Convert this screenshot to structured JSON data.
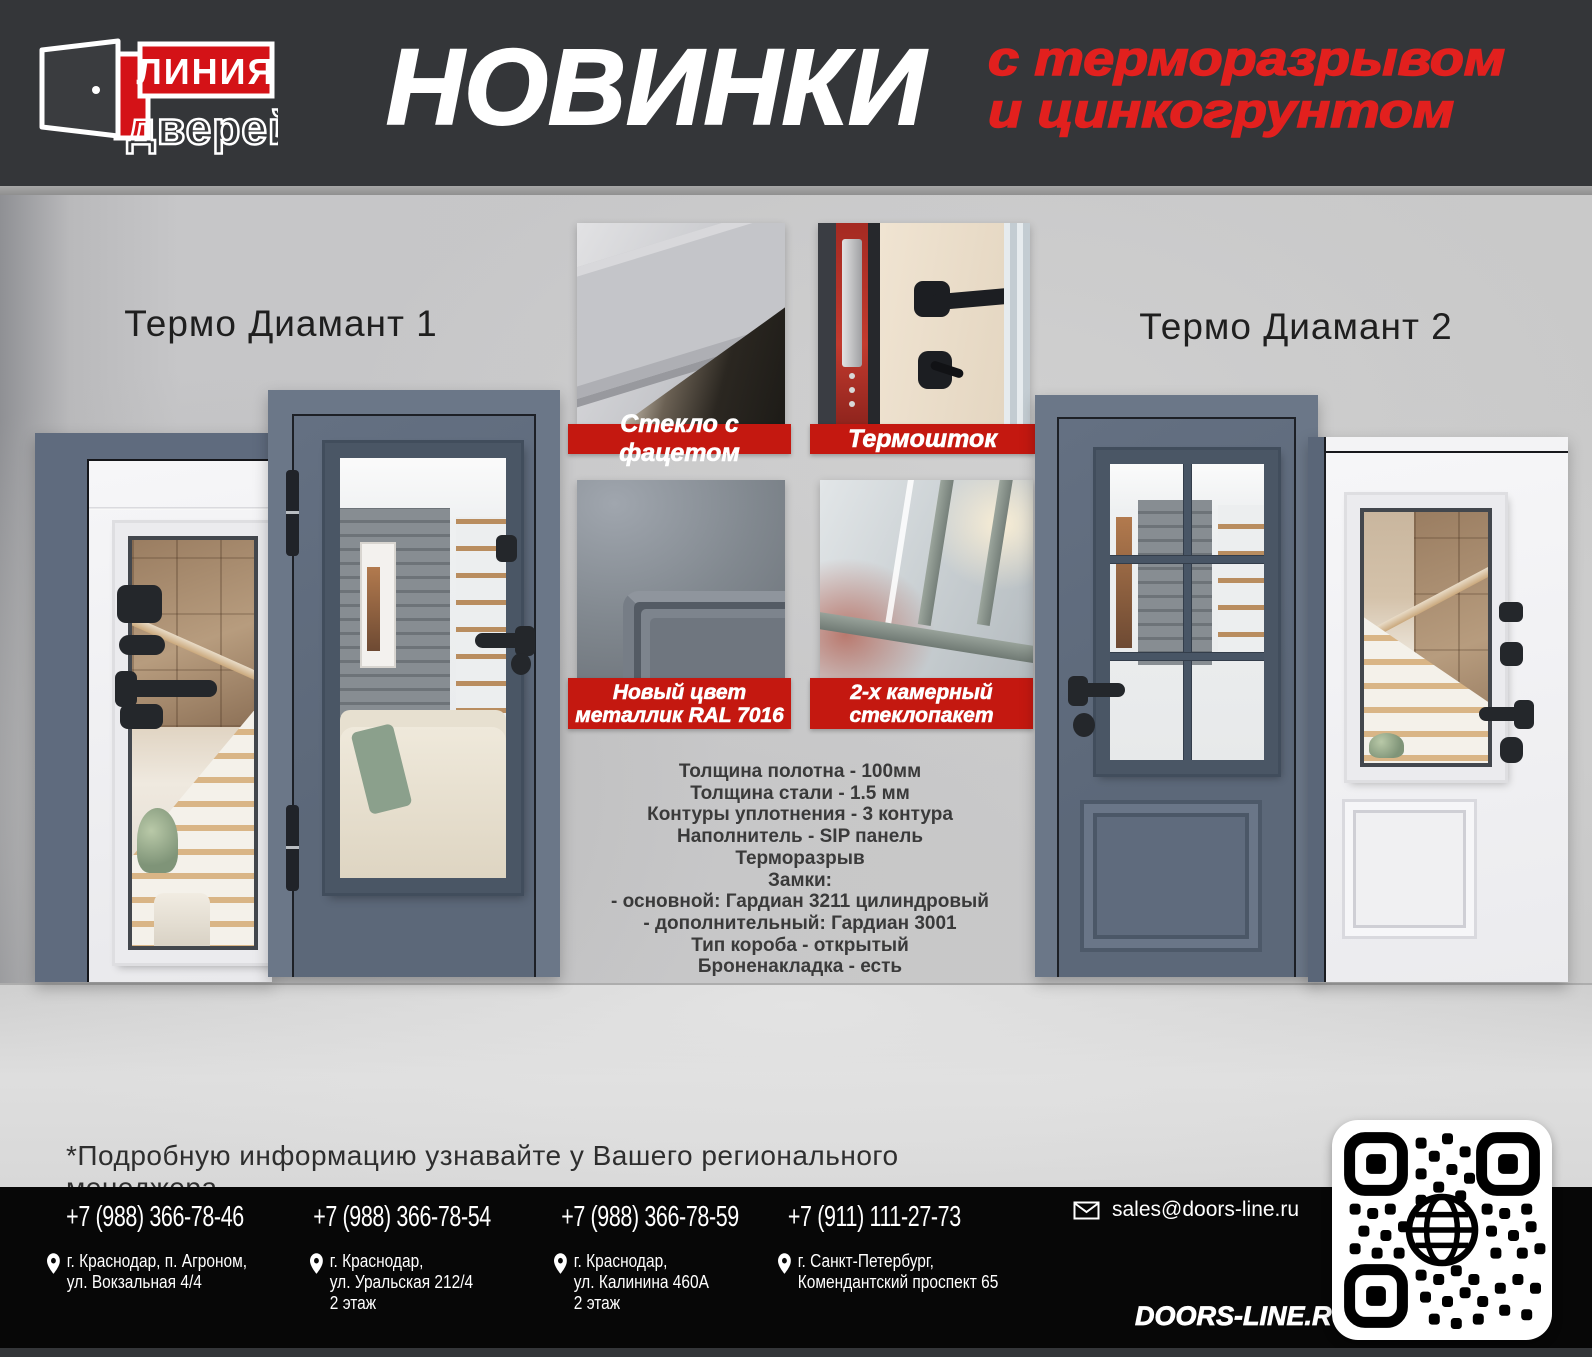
{
  "header": {
    "logo": {
      "icon": "open-door-icon",
      "line1": "ЛИНИЯ",
      "line2": "дверей"
    },
    "title": "НОВИНКИ",
    "subtitle_line1": "с терморазрывом",
    "subtitle_line2": "и цинкогрунтом"
  },
  "products": [
    {
      "name": "Термо Диамант 1"
    },
    {
      "name": "Термо Диамант 2"
    }
  ],
  "features": [
    {
      "line1": "Стекло с фацетом",
      "line2": ""
    },
    {
      "line1": "Термошток",
      "line2": ""
    },
    {
      "line1": "Новый цвет",
      "line2": "металлик RAL 7016"
    },
    {
      "line1": "2-х камерный",
      "line2": "стеклопакет"
    }
  ],
  "specs": {
    "lines": [
      "Толщина полотна - 100мм",
      "Толщина стали - 1.5 мм",
      "Контуры уплотнения - 3 контура",
      "Наполнитель - SIP панель",
      "Терморазрыв",
      "Замки:",
      "- основной: Гардиан 3211 цилиндровый",
      "- дополнительный: Гардиан 3001",
      "Тип короба - открытый",
      "Броненакладка - есть"
    ]
  },
  "note": {
    "text": "*Подробную информацию узнавайте у Вашего регионального менеджера."
  },
  "footer": {
    "contacts": [
      {
        "phone": "+7 (988) 366-78-46",
        "address_line1": "г. Краснодар, п. Агроном,",
        "address_line2": "ул. Вокзальная 4/4",
        "address_line3": ""
      },
      {
        "phone": "+7 (988) 366-78-54",
        "address_line1": "г. Краснодар,",
        "address_line2": "ул. Уральская 212/4",
        "address_line3": "2 этаж"
      },
      {
        "phone": "+7 (988) 366-78-59",
        "address_line1": "г. Краснодар,",
        "address_line2": "ул. Калинина 460А",
        "address_line3": "2 этаж"
      },
      {
        "phone": "+7 (911) 111-27-73",
        "address_line1": "г. Санкт-Петербург,",
        "address_line2": "Комендантский проспект 65",
        "address_line3": ""
      }
    ],
    "email": "sales@doors-line.ru",
    "website": "DOORS-LINE.RU",
    "icons": {
      "email": "envelope-icon",
      "address": "location-pin-icon",
      "qr": "qr-code-with-globe"
    }
  },
  "colors": {
    "accent_red": "#c41810",
    "header_red_text": "#e2201e",
    "header_bg": "#343639",
    "footer_bg": "#070707",
    "dark_door": "#5c6879",
    "white_door": "#f3f3f5",
    "wall": "#c7c7c7"
  }
}
